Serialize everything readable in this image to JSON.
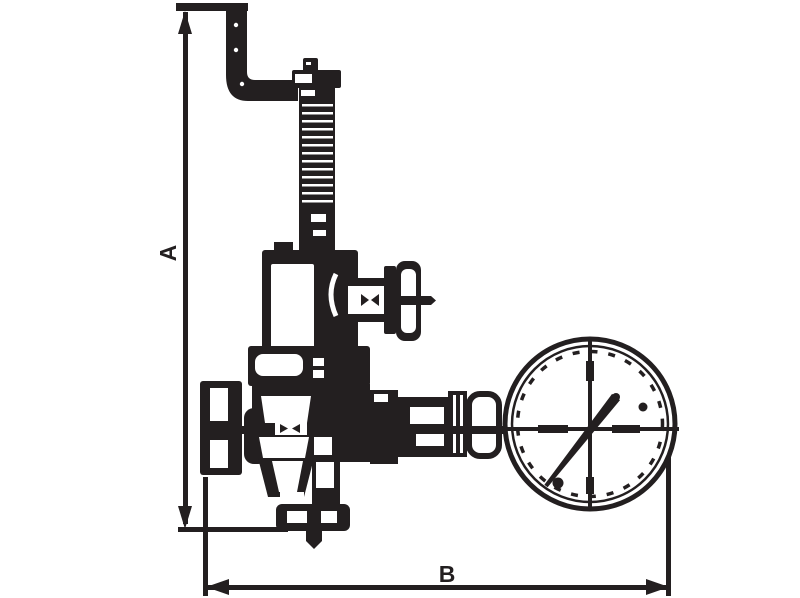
{
  "page": {
    "background_color": "#FFFFFF",
    "ink_color": "#231F20"
  },
  "drawing": {
    "type": "technical-dimension-drawing",
    "dimensions": {
      "a_label": "A",
      "b_label": "B"
    },
    "components": [
      "vent-pipe-elbow",
      "adjusting-screw-column",
      "spring-housing",
      "side-handwheel-valve",
      "upper-flange",
      "valve-body",
      "inlet-union-cap",
      "gauge-connection-union",
      "pressure-gauge",
      "bottom-outlet-flange"
    ]
  }
}
